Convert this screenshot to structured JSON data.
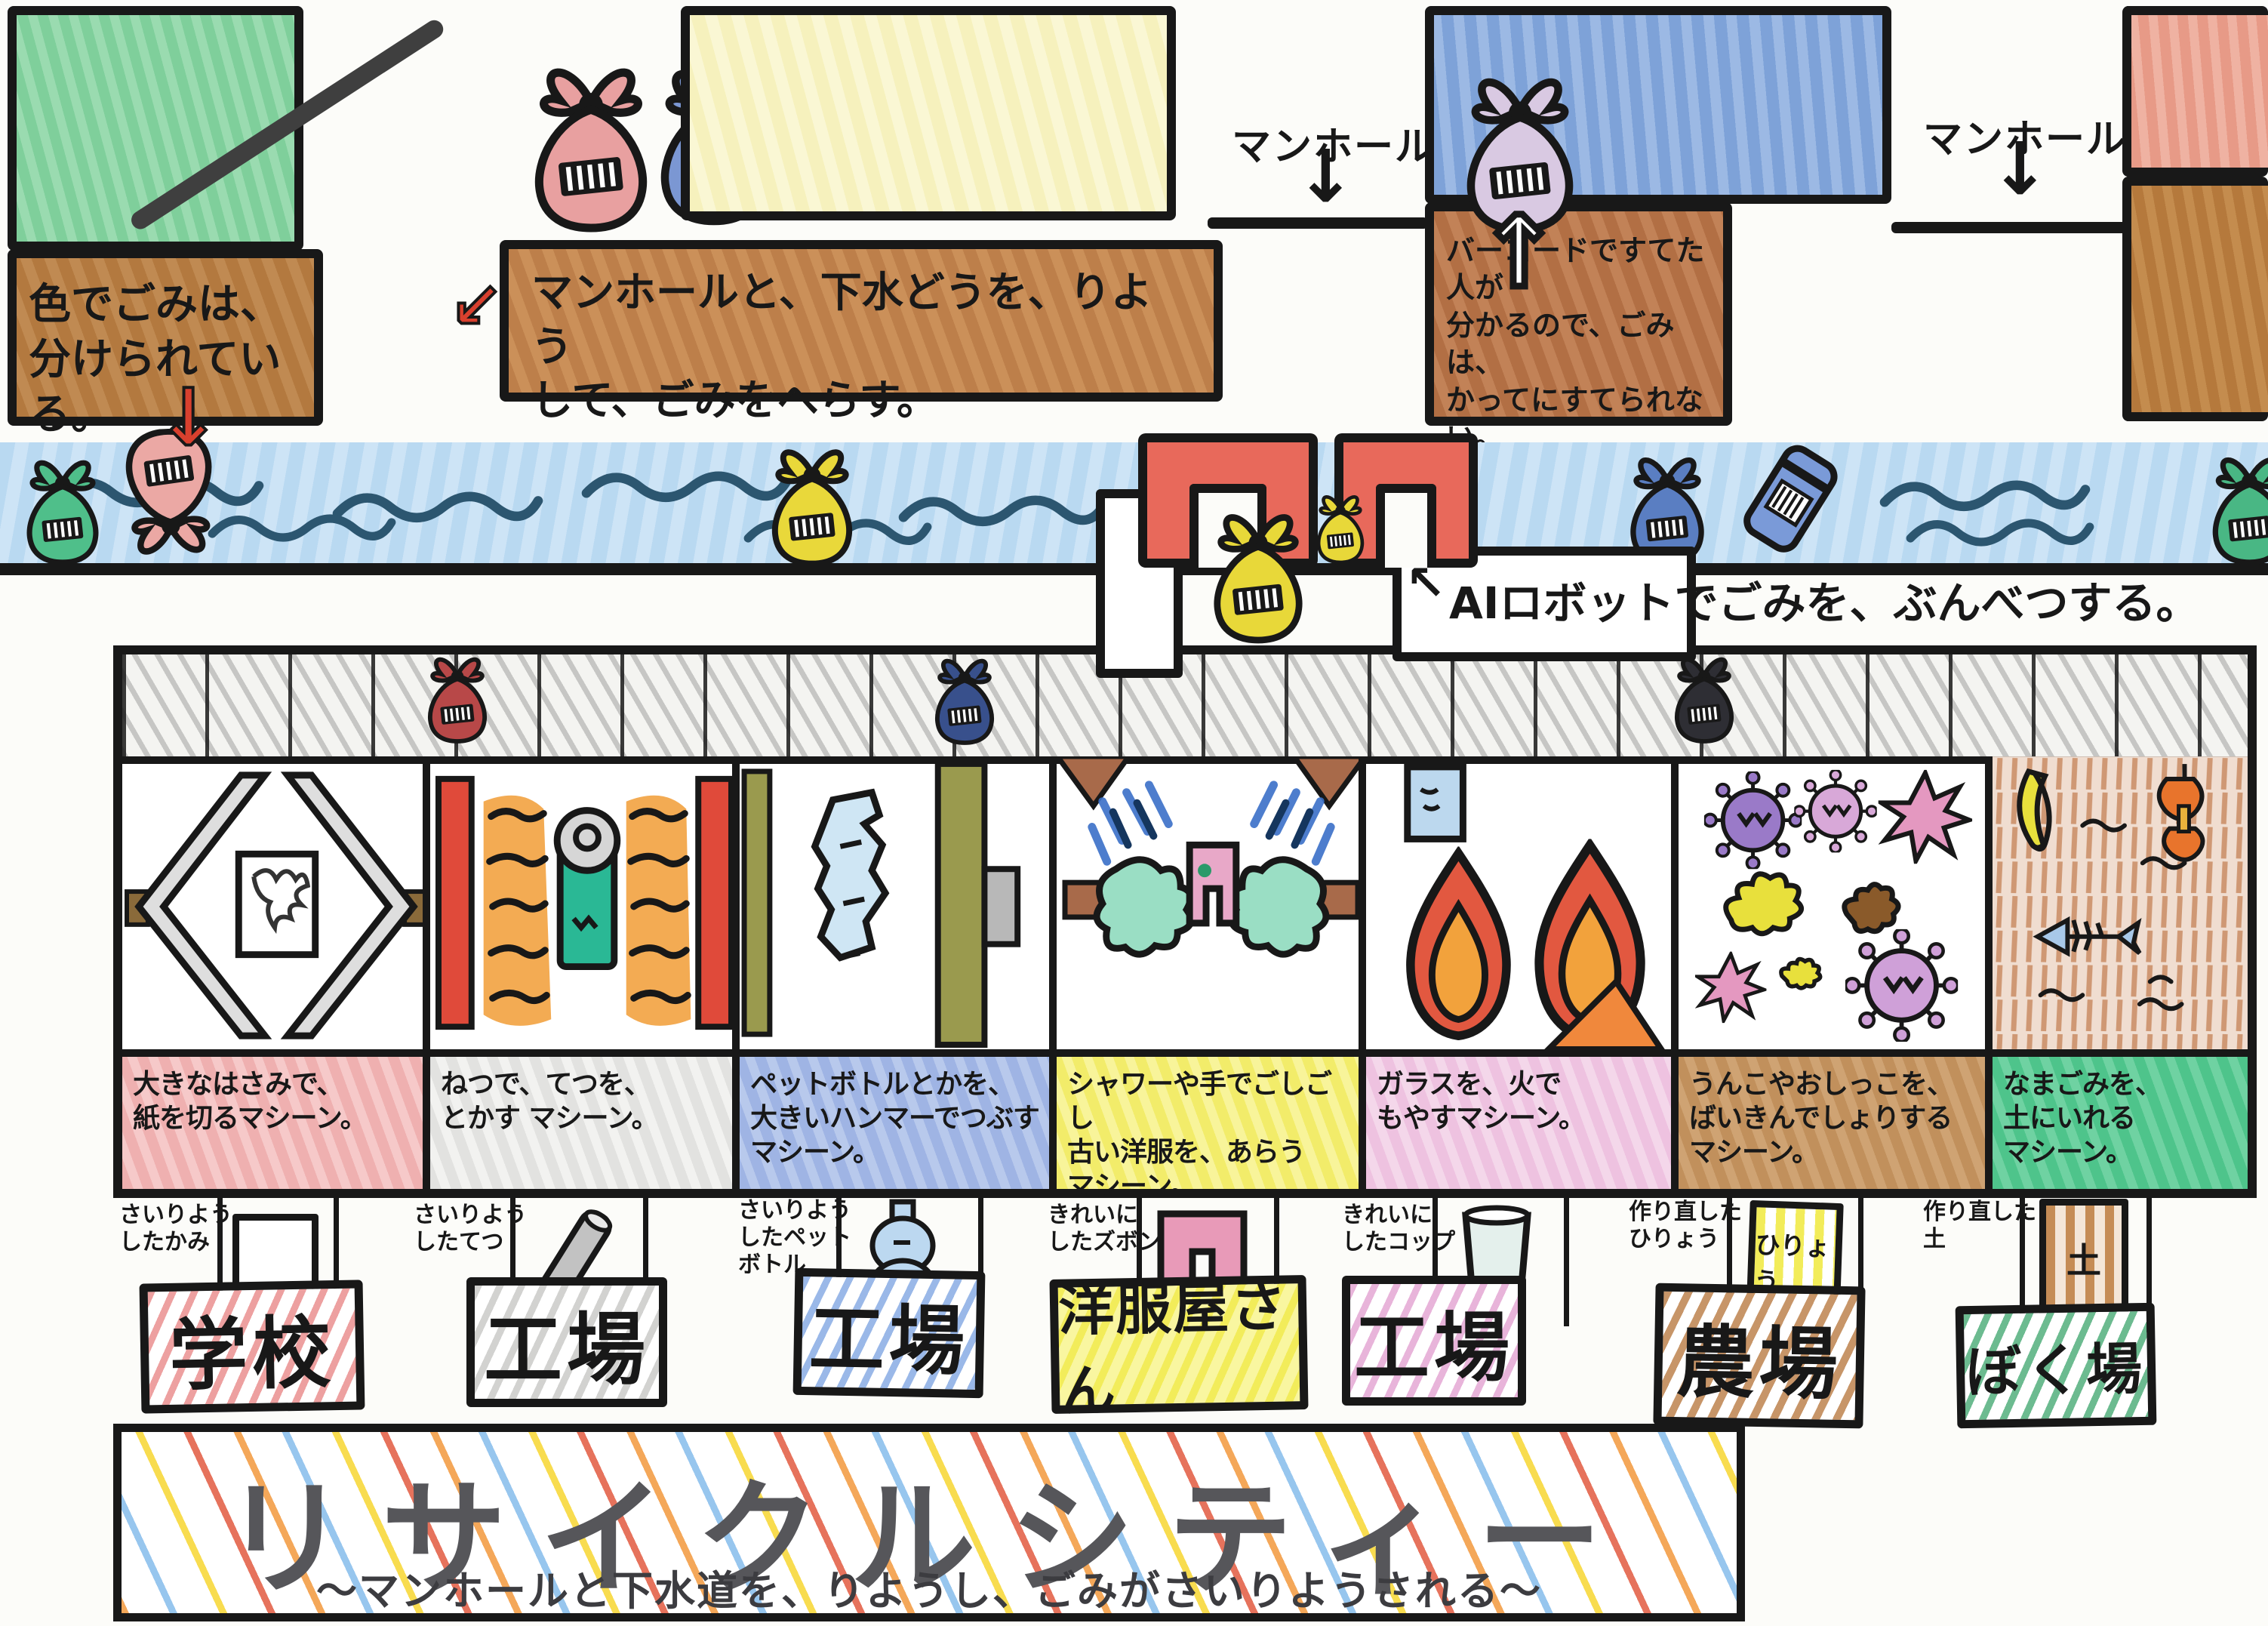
{
  "top": {
    "note_color_sort": "色でごみは、\n分けられている。",
    "banner_manhole": "マンホールと、下水どうを、りよう\nして、ごみをへらす。",
    "note_barcode": "バーコードですてた人が\n分かるので、ごみは、\nかってにすてられない。",
    "manhole_label_1": "マンホール",
    "manhole_label_2": "マンホール",
    "ai_note": "AIロボットでごみを、ぶんべつする。"
  },
  "icons": {
    "down_arrow": "↓",
    "up_arrow": "↑",
    "banner_arrow": "↙",
    "ai_pointer": "↖"
  },
  "machines": [
    {
      "id": "paper-cutting-machine",
      "description": "大きなはさみで、\n紙を切るマシーン。",
      "output_label": "さいりよう\nしたかみ",
      "destination": "学校",
      "desc_bg": "#efb0b0",
      "sign_color": "#e06a6a"
    },
    {
      "id": "iron-melting-machine",
      "description": "ねつで、てつを、\nとかす マシーン。",
      "output_label": "さいりよう\nしたてつ",
      "destination": "工場",
      "desc_bg": "#e2e2e0",
      "sign_color": "#b8b8b6"
    },
    {
      "id": "bottle-crushing-machine",
      "description": "ペットボトルとかを、\n大きいハンマーでつぶす\nマシーン。",
      "output_label": "さいりよう\nしたペット\nボトル",
      "destination": "工場",
      "desc_bg": "#9fb4e4",
      "sign_color": "#5b8fd6"
    },
    {
      "id": "clothes-washing-machine",
      "description": "シャワーや手でごしごし\n古い洋服を、あらう\nマシーン。",
      "output_label": "きれいに\nしたズボン",
      "destination": "洋服屋さん",
      "desc_bg": "#f2ec6a",
      "sign_color": "#e8e23c"
    },
    {
      "id": "glass-burning-machine",
      "description": "ガラスを、火で\nもやすマシーン。",
      "output_label": "きれいに\nしたコップ",
      "destination": "工場",
      "desc_bg": "#eec2e0",
      "sign_color": "#e0a0cc"
    },
    {
      "id": "sewage-processing-machine",
      "description": "うんこやおしっこを、\nばいきんでしょりする\nマシーン。",
      "output_label": "作り直した\nひりょう",
      "destination": "農場",
      "desc_bg": "#c1905c",
      "sign_color": "#a8713c"
    },
    {
      "id": "compost-machine",
      "description": "なまごみを、\n土にいれる\nマシーン。",
      "output_label": "作り直した\n土",
      "destination": "ぼく場",
      "desc_bg": "#4ec48b",
      "sign_color": "#4aa878"
    }
  ],
  "items": {
    "fertilizer_bag_label": "ひりょう",
    "soil_bag_label": "土"
  },
  "title": {
    "main": "リサイクルシティー",
    "subtitle": "〜マンホールと下水道を、りようし、ごみがさいりようされる〜"
  },
  "colors": {
    "green_building": "#8bd2a2",
    "yellow_building": "#f6f1bd",
    "blue_building": "#8aaede",
    "salmon_building": "#e79a87",
    "note_brown": "#bd7f4a",
    "river_blue": "#bedbf2",
    "claw_red": "#e8695b"
  }
}
